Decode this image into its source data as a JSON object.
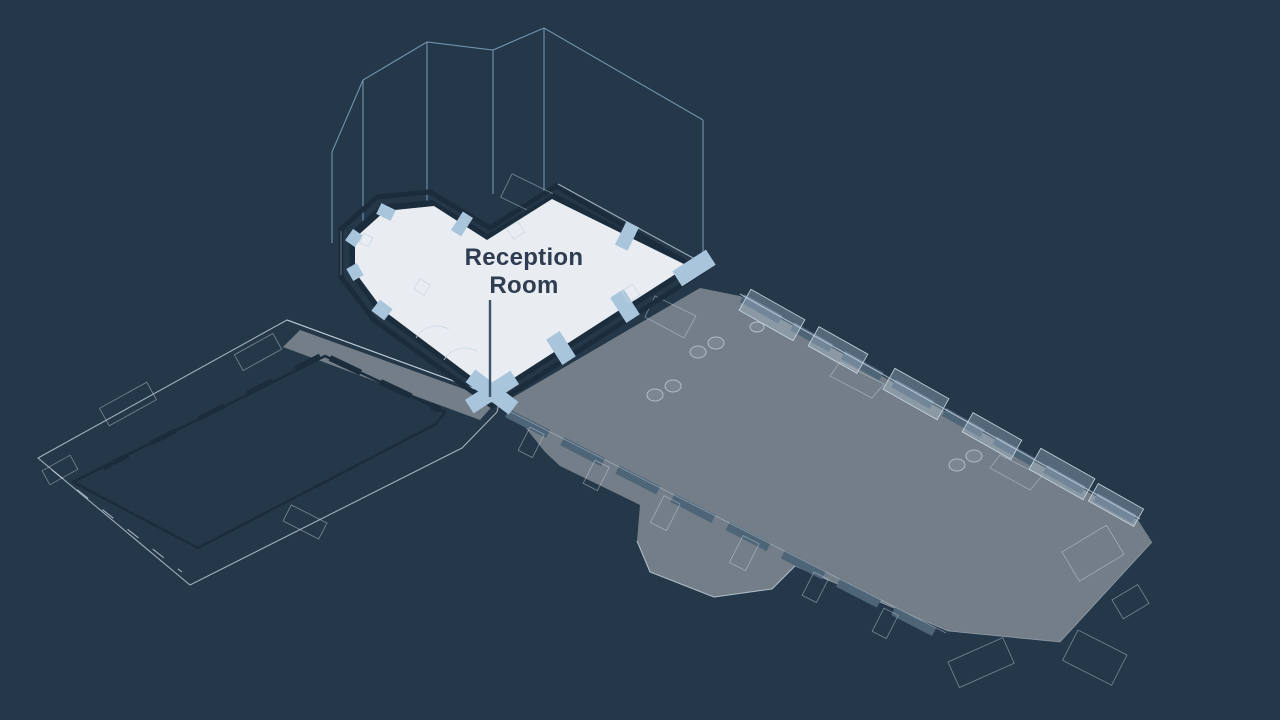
{
  "label": {
    "room_name": "Reception Room"
  },
  "scene": {
    "highlighted_room": "Reception Room"
  },
  "colors": {
    "background": "#253849",
    "floor_gray": "#737e88",
    "wall_slate": "#4e6578",
    "wall_slate_light": "#62798c",
    "wall_light": "#a8c5dc",
    "wall_pale": "#d9e6f0",
    "floor_highlight": "#e9edf2",
    "wall_dark": "#1b2c3c",
    "wireframe": "#7a9cb8",
    "edge_light": "#c9d8e4",
    "label_text": "#2e3d51",
    "leader": "#3e546c"
  }
}
